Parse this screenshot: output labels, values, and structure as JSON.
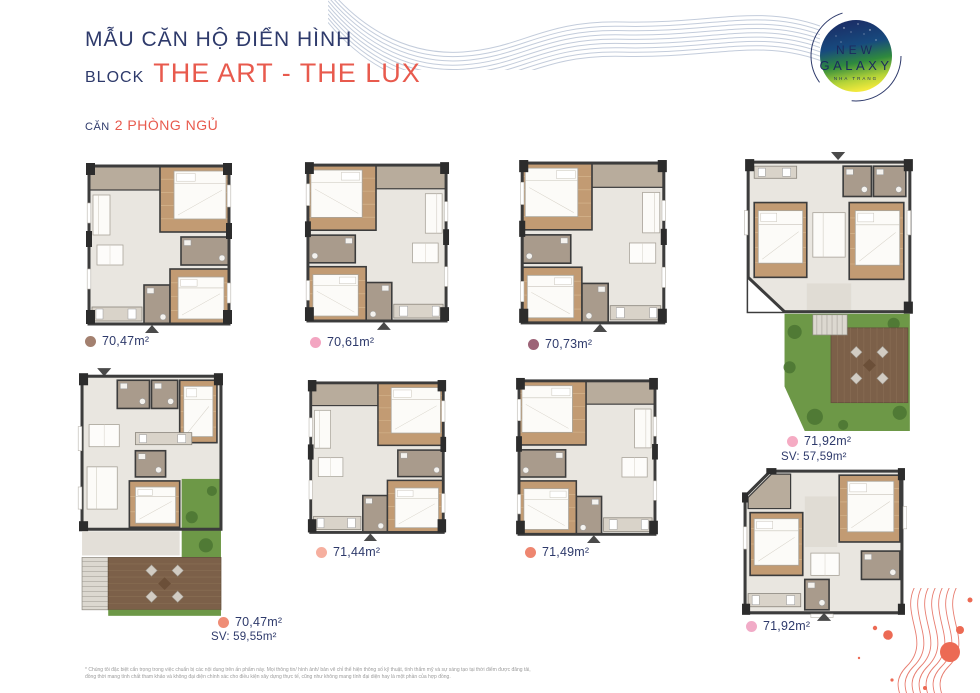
{
  "header": {
    "title": "MẪU CĂN HỘ ĐIỂN HÌNH",
    "block_prefix": "BLOCK",
    "block_name": "THE ART - THE LUX",
    "unit_prefix": "CĂN",
    "unit_type": "2 PHÒNG NGỦ"
  },
  "logo": {
    "line1": "NEW",
    "line2": "GALAXY",
    "line3": "NHA TRANG"
  },
  "units": [
    {
      "area": "70,47m²",
      "sv": "",
      "dot_color": "#a3806f",
      "variant": "small"
    },
    {
      "area": "70,61m²",
      "sv": "",
      "dot_color": "#f3a5c1",
      "variant": "small-m"
    },
    {
      "area": "70,73m²",
      "sv": "",
      "dot_color": "#9d6377",
      "variant": "small-m"
    },
    {
      "area": "71,92m²",
      "sv": "SV: 57,59m²",
      "dot_color": "#f5abc3",
      "variant": "garden-right"
    },
    {
      "area": "70,47m²",
      "sv": "SV: 59,55m²",
      "dot_color": "#ef8d76",
      "variant": "garden-bottom"
    },
    {
      "area": "71,44m²",
      "sv": "",
      "dot_color": "#f6af9f",
      "variant": "small"
    },
    {
      "area": "71,49m²",
      "sv": "",
      "dot_color": "#ee8670",
      "variant": "small-m"
    },
    {
      "area": "71,92m²",
      "sv": "",
      "dot_color": "#f1abc7",
      "variant": "wide"
    }
  ],
  "footer": {
    "disclaimer_line1": "* Chúng tôi đặc biệt cẩn trọng trong việc chuẩn bị các nội dung trên ấn phẩm này. Mọi thông tin/ hình ảnh/ bản vẽ chỉ thể hiện thông số kỹ thuật, tính thẩm mỹ và sự sáng tạo tại thời điểm được đăng tải,",
    "disclaimer_line2": "đồng thời mang tính chất tham khảo và không đại diện chính xác cho điều kiện xây dựng thực tế, cũng như không mang tính đại diện hay là một phần của hợp đồng."
  },
  "colors": {
    "navy": "#2e3a6b",
    "coral": "#e85a4d",
    "wave_blue": "#c3ccdb",
    "wave_coral": "#e87d70",
    "wall": "#3c3c3c",
    "floor": "#e9e6e0",
    "taupe": "#a99b8c",
    "wood": "#c29b73",
    "garden": "#6d9847",
    "deck": "#7c6049"
  }
}
